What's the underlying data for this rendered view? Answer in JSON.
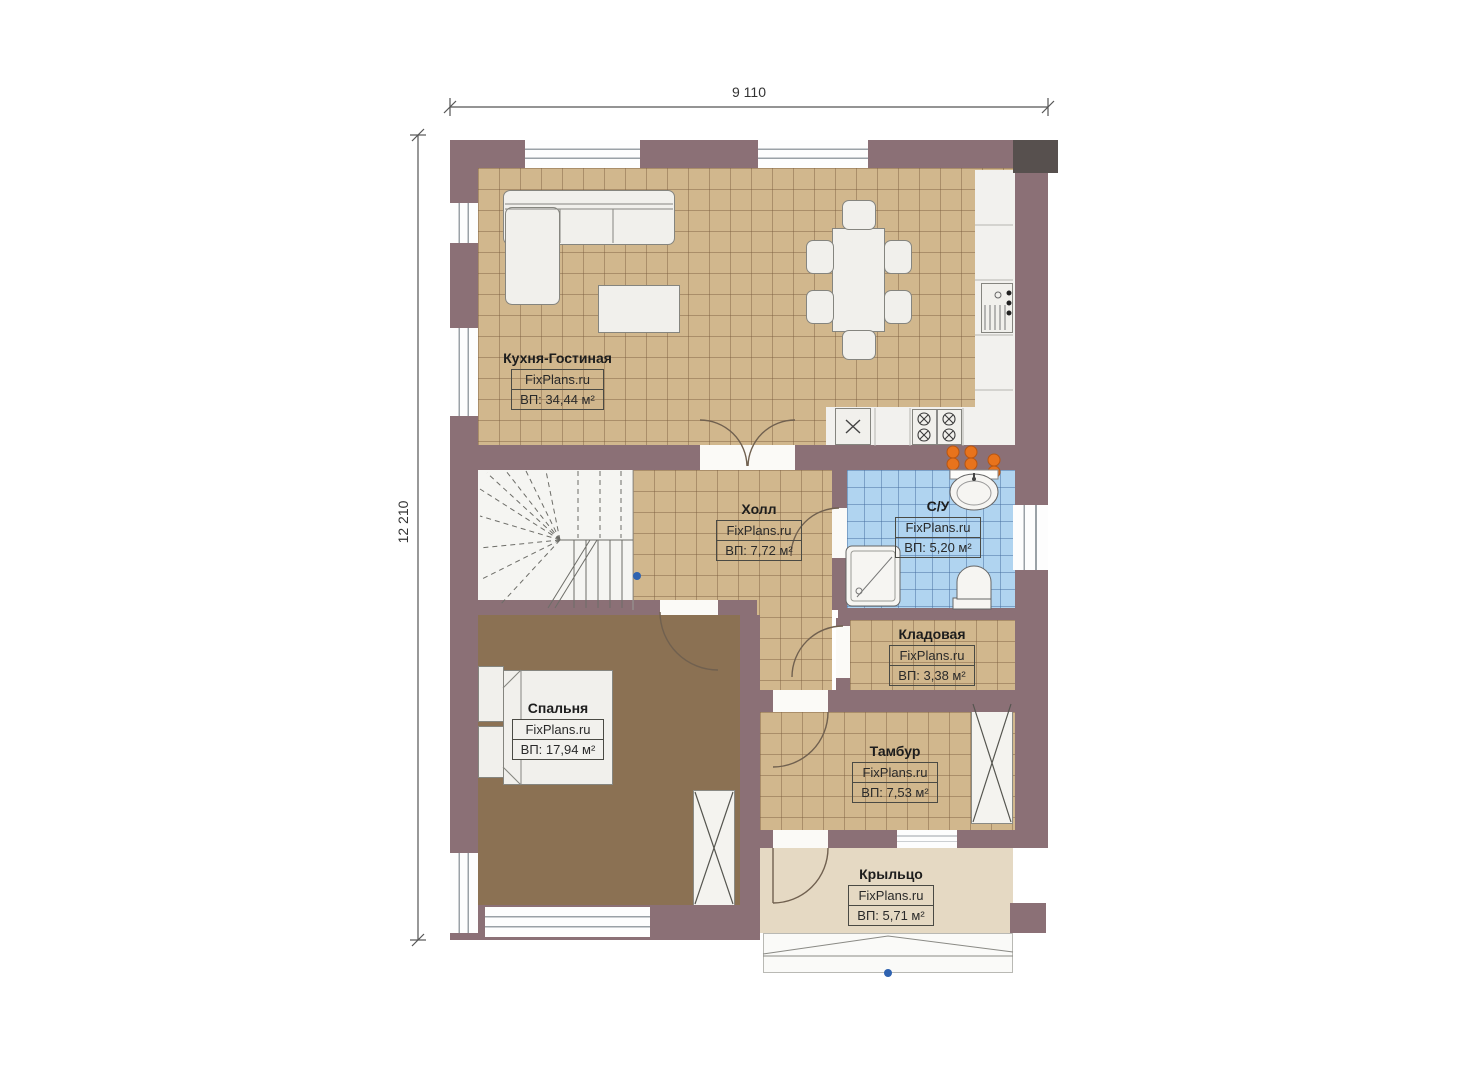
{
  "dimensions": {
    "top": "9 110",
    "left": "12 210"
  },
  "rooms": [
    {
      "id": "kitchen",
      "name": "Кухня-Гостиная",
      "brand": "FixPlans.ru",
      "area": "ВП: 34,44 м²"
    },
    {
      "id": "hall",
      "name": "Холл",
      "brand": "FixPlans.ru",
      "area": "ВП: 7,72 м²"
    },
    {
      "id": "bathroom",
      "name": "С/У",
      "brand": "FixPlans.ru",
      "area": "ВП: 5,20 м²"
    },
    {
      "id": "storage",
      "name": "Кладовая",
      "brand": "FixPlans.ru",
      "area": "ВП: 3,38 м²"
    },
    {
      "id": "bedroom",
      "name": "Спальня",
      "brand": "FixPlans.ru",
      "area": "ВП: 17,94 м²"
    },
    {
      "id": "vestibule",
      "name": "Тамбур",
      "brand": "FixPlans.ru",
      "area": "ВП: 7,53 м²"
    },
    {
      "id": "porch",
      "name": "Крыльцо",
      "brand": "FixPlans.ru",
      "area": "ВП: 5,71 м²"
    }
  ],
  "colors": {
    "wall": "#8b7076",
    "tile_floor": "#d1b78d",
    "bath_tile": "#b0d4f0",
    "bedroom_floor": "#8b7153",
    "porch_floor": "#e5d9c3",
    "stair_area": "#f5f5f2",
    "riser_orange": "#e8731c",
    "marker_blue": "#2f63b0"
  }
}
